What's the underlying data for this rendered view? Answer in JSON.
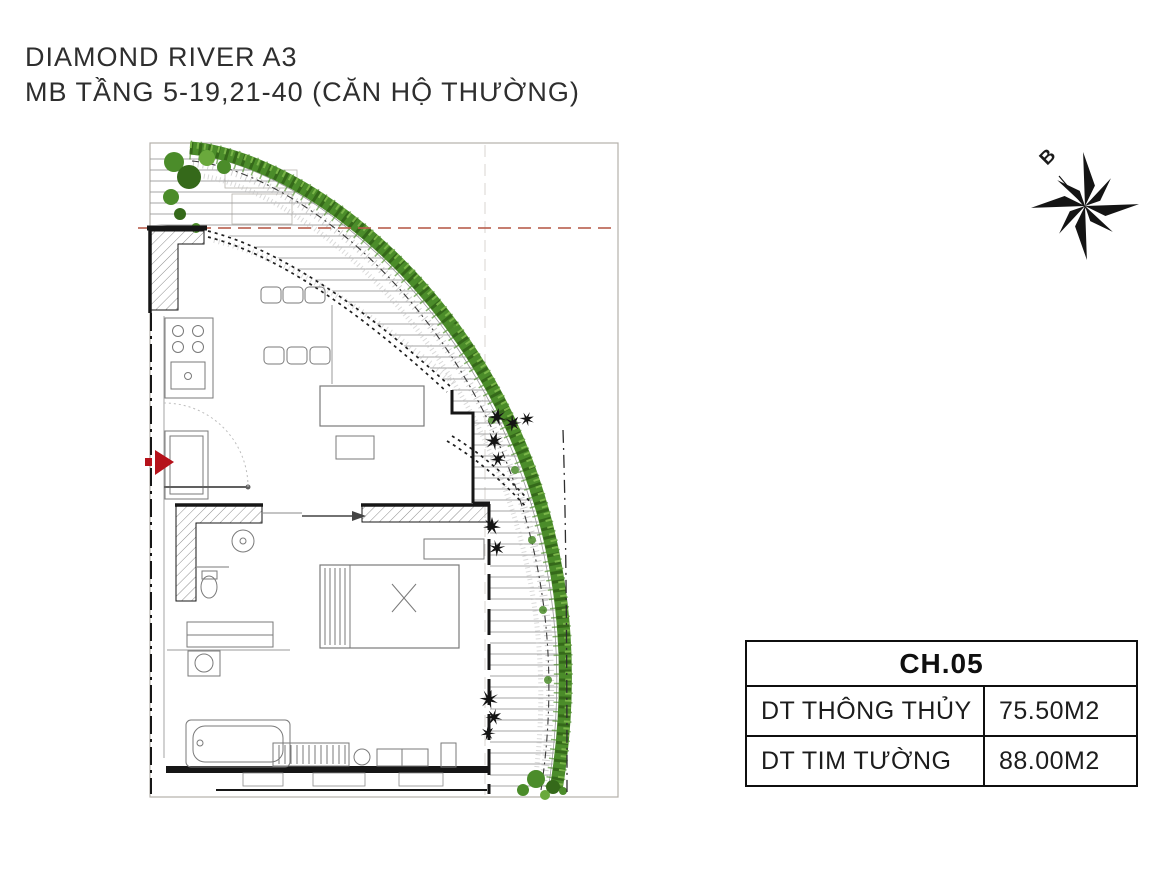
{
  "page": {
    "width": 1170,
    "height": 878,
    "background": "#ffffff"
  },
  "title": {
    "line1": "DIAMOND RIVER A3",
    "line2": "MB TẦNG 5-19,21-40 (CĂN HỘ THƯỜNG)"
  },
  "compass": {
    "label": "B"
  },
  "info_table": {
    "header": "CH.05",
    "rows": [
      {
        "label": "DT THÔNG THỦY",
        "value": "75.50M2"
      },
      {
        "label": "DT TIM TƯỜNG",
        "value": "88.00M2"
      }
    ]
  },
  "floor_plan": {
    "unit_code": "CH.05",
    "description": "Corner apartment floor plan with curved planted balcony edge, living-dining area, kitchen, bedroom and bathrooms",
    "colors": {
      "vegetation": "#4b8c2a",
      "vegetation_dark": "#35691a",
      "vegetation_light": "#79b548",
      "grid_line_red": "#b85c4a",
      "entry_arrow_red": "#b5121b",
      "walls": "#161616",
      "hatch": "#9a9a9a",
      "frame": "#b5b0ab"
    }
  }
}
